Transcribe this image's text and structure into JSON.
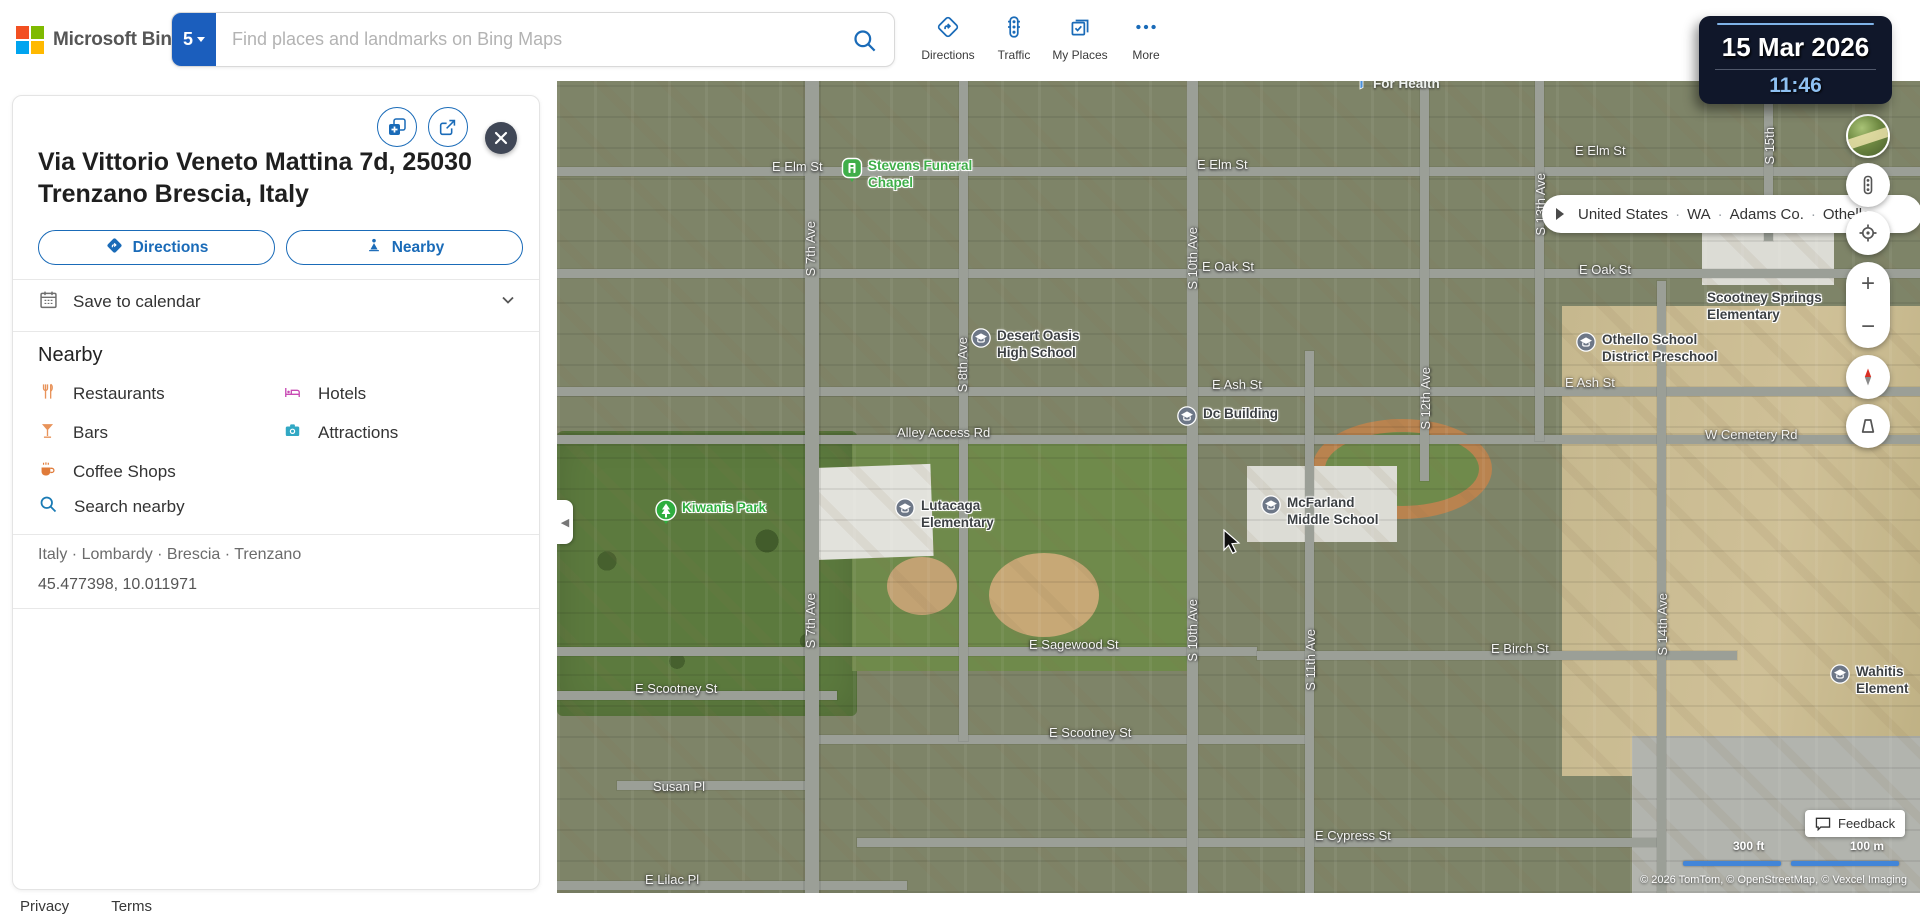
{
  "topbar": {
    "logo": "Microsoft Bing",
    "search": {
      "badge": "5",
      "placeholder": "Find places and landmarks on Bing Maps"
    },
    "nav": [
      {
        "label": "Directions"
      },
      {
        "label": "Traffic"
      },
      {
        "label": "My Places"
      },
      {
        "label": "More"
      }
    ]
  },
  "clock": {
    "date": "15 Mar 2026",
    "time": "11:46"
  },
  "panel": {
    "title": "Via Vittorio Veneto Mattina 7d, 25030 Trenzano Brescia, Italy",
    "directions_button": "Directions",
    "nearby_button": "Nearby",
    "save_to_calendar": "Save to calendar",
    "nearby_heading": "Nearby",
    "categories": [
      {
        "label": "Restaurants",
        "icon": "restaurants-icon",
        "color": "#e8935a"
      },
      {
        "label": "Hotels",
        "icon": "hotels-icon",
        "color": "#c84bb4"
      },
      {
        "label": "Bars",
        "icon": "bars-icon",
        "color": "#e8935a"
      },
      {
        "label": "Attractions",
        "icon": "attractions-icon",
        "color": "#31a8c4"
      },
      {
        "label": "Coffee Shops",
        "icon": "coffee-icon",
        "color": "#e07b39"
      }
    ],
    "search_nearby": "Search nearby",
    "region_breadcrumb": "Italy · Lombardy · Brescia · Trenzano",
    "coordinates": "45.477398, 10.011971"
  },
  "footer": {
    "privacy": "Privacy",
    "terms": "Terms"
  },
  "map": {
    "breadcrumb": {
      "items": [
        "United States",
        "WA",
        "Adams Co.",
        "Othello"
      ]
    },
    "feedback": "Feedback",
    "scale_ft": "300 ft",
    "scale_m": "100 m",
    "copyright": "© 2026 TomTom, © OpenStreetMap, © Vexcel Imaging",
    "street_labels": [
      {
        "text": "E Elm St",
        "x": 215,
        "y": 78
      },
      {
        "text": "E Elm St",
        "x": 640,
        "y": 76
      },
      {
        "text": "E Elm St",
        "x": 1018,
        "y": 62
      },
      {
        "text": "E Oak St",
        "x": 645,
        "y": 178
      },
      {
        "text": "E Oak St",
        "x": 1022,
        "y": 181
      },
      {
        "text": "E Ash St",
        "x": 655,
        "y": 296
      },
      {
        "text": "E Ash St",
        "x": 1008,
        "y": 294
      },
      {
        "text": "Alley Access Rd",
        "x": 340,
        "y": 344
      },
      {
        "text": "W Cemetery Rd",
        "x": 1148,
        "y": 346
      },
      {
        "text": "E Sagewood St",
        "x": 472,
        "y": 556
      },
      {
        "text": "E Scootney St",
        "x": 78,
        "y": 600
      },
      {
        "text": "E Scootney St",
        "x": 492,
        "y": 644
      },
      {
        "text": "E Birch St",
        "x": 934,
        "y": 560
      },
      {
        "text": "E Cypress St",
        "x": 758,
        "y": 747
      },
      {
        "text": "Susan Pl",
        "x": 96,
        "y": 698
      },
      {
        "text": "E Lilac Pl",
        "x": 88,
        "y": 791
      },
      {
        "text": "S 7th Ave",
        "x": 246,
        "y": 140,
        "v": true
      },
      {
        "text": "S 7th Ave",
        "x": 246,
        "y": 512,
        "v": true
      },
      {
        "text": "S 8th Ave",
        "x": 398,
        "y": 256,
        "v": true
      },
      {
        "text": "S 10th Ave",
        "x": 628,
        "y": 146,
        "v": true
      },
      {
        "text": "S 10th Ave",
        "x": 628,
        "y": 518,
        "v": true
      },
      {
        "text": "S 11th Ave",
        "x": 746,
        "y": 548,
        "v": true
      },
      {
        "text": "S 12th Ave",
        "x": 861,
        "y": 286,
        "v": true
      },
      {
        "text": "S 13th Ave",
        "x": 976,
        "y": 92,
        "v": true
      },
      {
        "text": "S 14th Ave",
        "x": 1098,
        "y": 512,
        "v": true
      },
      {
        "text": "S 15th",
        "x": 1205,
        "y": 46,
        "v": true
      }
    ],
    "poi_labels": [
      {
        "lines": [
          "Stevens Funeral",
          "Chapel"
        ],
        "x": 284,
        "y": 76,
        "type": "place"
      },
      {
        "lines": [
          "Desert Oasis",
          "High School"
        ],
        "x": 413,
        "y": 246,
        "type": "school"
      },
      {
        "lines": [
          "Dc Building"
        ],
        "x": 619,
        "y": 324,
        "type": "school"
      },
      {
        "lines": [
          "Kiwanis Park"
        ],
        "x": 98,
        "y": 418,
        "type": "park"
      },
      {
        "lines": [
          "Lutacaga",
          "Elementary"
        ],
        "x": 337,
        "y": 416,
        "type": "school"
      },
      {
        "lines": [
          "McFarland",
          "Middle School"
        ],
        "x": 703,
        "y": 413,
        "type": "school"
      },
      {
        "lines": [
          "Scootney Springs",
          "Elementary"
        ],
        "x": 1150,
        "y": 208,
        "type": "text"
      },
      {
        "lines": [
          "Othello School",
          "District Preschool"
        ],
        "x": 1018,
        "y": 250,
        "type": "school"
      },
      {
        "lines": [
          "Wahitis",
          "Element"
        ],
        "x": 1272,
        "y": 582,
        "type": "school"
      },
      {
        "lines": [
          "For Health"
        ],
        "x": 798,
        "y": -6,
        "type": "health"
      }
    ]
  },
  "colors": {
    "accent": "#1a6bb8",
    "badge_blue": "#1b5ebd",
    "clock_time": "#8fc1f2",
    "scale_bar": "#4285d8"
  }
}
